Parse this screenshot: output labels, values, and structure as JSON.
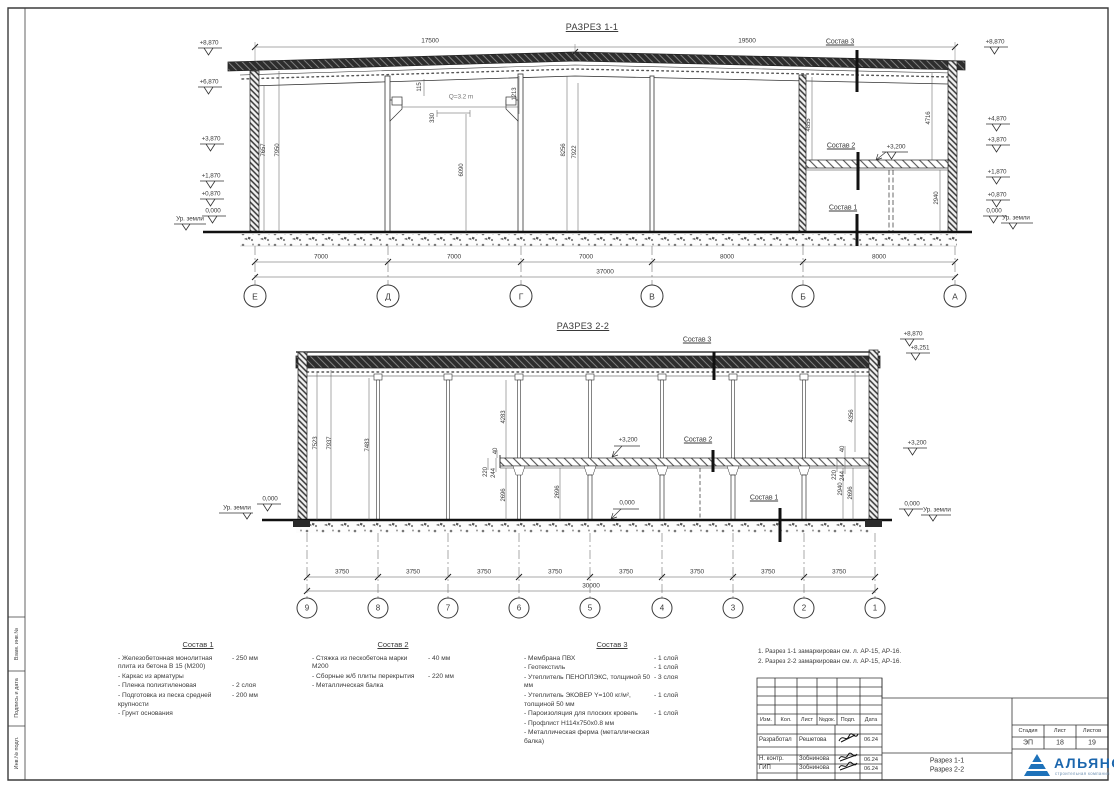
{
  "frame": {
    "stamps": [
      "Взам. инв.№",
      "Подпись и дата",
      "Инв.№ подл."
    ]
  },
  "s1": {
    "title": "РАЗРЕЗ 1-1",
    "dimTop": [
      "17500",
      "19500"
    ],
    "crane": "Q=3.2 m",
    "elevL": [
      "+8,870",
      "+6,870",
      "+3,870",
      "+1,870",
      "+0,870",
      "0,000"
    ],
    "elevR": [
      "+8,870",
      "+4,870",
      "+3,870",
      "+1,870",
      "+0,870",
      "0,000"
    ],
    "ground": "Ур. земли",
    "lvl3200": "+3,200",
    "sostav1": "Состав 1",
    "sostav2": "Состав 2",
    "sostav3": "Состав 3",
    "v": {
      "a7657": "7657",
      "a7950": "7950",
      "a115": "115",
      "a1213": "1213",
      "a330": "330",
      "a6090": "6090",
      "a8256": "8256",
      "a7922": "7922",
      "a4855": "4855",
      "a4716": "4716",
      "a2940": "2940"
    },
    "spans": [
      "7000",
      "7000",
      "7000",
      "8000",
      "8000"
    ],
    "total": "37000",
    "axes": [
      "Е",
      "Д",
      "Г",
      "В",
      "Б",
      "А"
    ]
  },
  "s2": {
    "title": "РАЗРЕЗ 2-2",
    "elevTop": [
      "+8,870",
      "+8,251"
    ],
    "lvl3200": "+3,200",
    "zero": "0,000",
    "ground": "Ур. земли",
    "sostav1": "Состав 1",
    "sostav2": "Состав 2",
    "sostav3": "Состав 3",
    "v": {
      "a7523": "7523",
      "a7937": "7937",
      "a7483": "7483",
      "a4283": "4283",
      "a4356": "4356",
      "a40": "40",
      "a220": "220",
      "a244": "244",
      "a2696": "2696",
      "a2940": "2940"
    },
    "spans": [
      "3750",
      "3750",
      "3750",
      "3750",
      "3750",
      "3750",
      "3750",
      "3750"
    ],
    "total": "30000",
    "axes": [
      "9",
      "8",
      "7",
      "6",
      "5",
      "4",
      "3",
      "2",
      "1"
    ]
  },
  "legends": [
    {
      "title": "Состав 1",
      "items": [
        {
          "t": "- Железобетонная монолитная плита из бетона В 15 (М200)",
          "v": "- 250 мм"
        },
        {
          "t": "- Каркас из арматуры",
          "v": ""
        },
        {
          "t": "- Пленка полиэтиленовая",
          "v": "- 2 слоя"
        },
        {
          "t": "- Подготовка из песка средней крупности",
          "v": "- 200 мм"
        },
        {
          "t": "- Грунт основания",
          "v": ""
        }
      ]
    },
    {
      "title": "Состав 2",
      "items": [
        {
          "t": "- Стяжка из пескобетона марки М200",
          "v": "- 40 мм"
        },
        {
          "t": "- Сборные ж/б плиты перекрытия",
          "v": "- 220 мм"
        },
        {
          "t": "- Металлическая балка",
          "v": ""
        }
      ]
    },
    {
      "title": "Состав 3",
      "items": [
        {
          "t": "- Мембрана ПВХ",
          "v": "- 1 слой"
        },
        {
          "t": "- Геотекстиль",
          "v": "- 1 слой"
        },
        {
          "t": "- Утеплитель ПЕНОПЛЭКС, толщиной 50 мм",
          "v": "- 3 слоя"
        },
        {
          "t": "- Утеплитель ЭКОВЕР Y=100 кг/м², толщиной 50 мм",
          "v": "- 1 слой"
        },
        {
          "t": "- Пароизоляция для плоских кровель",
          "v": "- 1 слой"
        },
        {
          "t": "- Профлист  Н114х750х0.8 мм",
          "v": ""
        },
        {
          "t": "- Металлическая ферма (металлическая балка)",
          "v": ""
        }
      ]
    }
  ],
  "notes": [
    "1. Разрез 1-1 замаркирован см. л. АР-15, АР-16.",
    "2. Разрез 2-2 замаркирован см. л. АР-15, АР-16."
  ],
  "tb": {
    "cols": [
      "Изм.",
      "Кол.",
      "Лист",
      "№док.",
      "Подп.",
      "Дата"
    ],
    "rows": [
      {
        "r": "Разработал",
        "n": "Решетова",
        "d": "06.24"
      },
      {
        "r": "Н. контр.",
        "n": "Зобнинова",
        "d": "06.24"
      },
      {
        "r": "ГИП",
        "n": "Зобнинова",
        "d": "06.24"
      }
    ],
    "stage_h": [
      "Стадия",
      "Лист",
      "Листов"
    ],
    "stage_v": [
      "ЭП",
      "18",
      "19"
    ],
    "doc1": "Разрез 1-1",
    "doc2": "Разрез 2-2",
    "logo": "АЛЬЯНС",
    "logo_sub": "строительная компания",
    "logo_color": "#1b66ad"
  }
}
